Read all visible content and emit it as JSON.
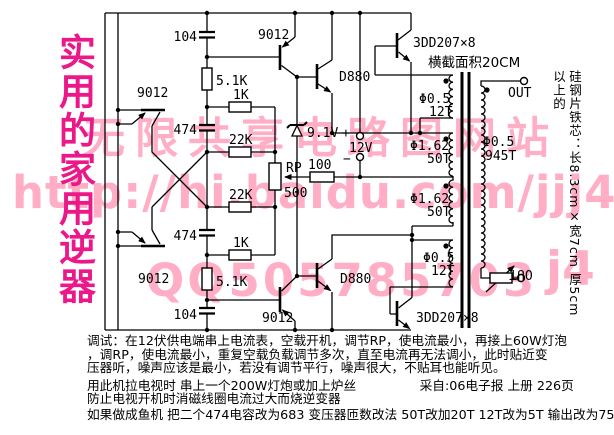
{
  "title": "实用的家用逆器",
  "watermark": {
    "site": "无限共享电路图网站",
    "url": "http://hi.baidu.com/jjj4",
    "qq": "QQ505785703",
    "fragment": "j4",
    "color": "#ffaec5"
  },
  "colors": {
    "title": "#ea1889",
    "line": "#000000",
    "background": "#ffffff"
  },
  "side_note": "硅钢片铁芯：长8.3cm×宽7cm 厚5cm 以上的",
  "sch": {
    "c104_top": "104",
    "c104_bot": "104",
    "c474_top": "474",
    "c474_bot": "474",
    "r51k_top": "5.1K",
    "r51k_bot": "5.1K",
    "r1k_top": "1K",
    "r1k_bot": "1K",
    "r22k_top": "22K",
    "r22k_bot": "22K",
    "r100": "100",
    "rp": "RP",
    "rp_val": "500",
    "q_tl": "9012",
    "q_tr": "9012",
    "q_bl": "9012",
    "q_br": "9012",
    "d880_top": "D880",
    "d880_bot": "D880",
    "q3dd_top": "3DD207×8",
    "q3dd_bot": "3DD207×8",
    "zener": "9.1V",
    "batt_plus": "+",
    "batt": "12V",
    "batt_minus": "−",
    "core_area": "横截面积20CM",
    "w1_wire": "Φ0.5",
    "w1_turns": "12T",
    "w2_wire": "Φ1.62",
    "w2_turns": "50T",
    "w3_wire": "Φ1.62",
    "w3_turns": "50T",
    "w4_wire": "Φ0.5",
    "w4_turns": "12T",
    "sec_wire": "Φ0.5",
    "sec_turns": "945T",
    "out_top": "OUT",
    "out_bot": "OUT"
  },
  "notes": {
    "lines": [
      "调试：在12伏供电端串上电流表，空载开机，调节RP，使电流最小，再接上60W灯泡",
      "，调RP，使电流最小，重复空载负载调节多次，直至电流再无法调小，此时贴近变",
      "压器听，噪声应该是最小，若没有调节平行，噪声很大，不贴耳也能听见。",
      "用此机拉电视时 串上一个200W灯炮或加上炉丝　　　　　采自:06电子报 上册 226页",
      "防止电视开机时消磁线圈电流过大而烧逆变器",
      "如果做成鱼机 把二个474电容改为683 变压器匝数改法 50T改加20T 12T改为5T 输出改为750T"
    ]
  }
}
